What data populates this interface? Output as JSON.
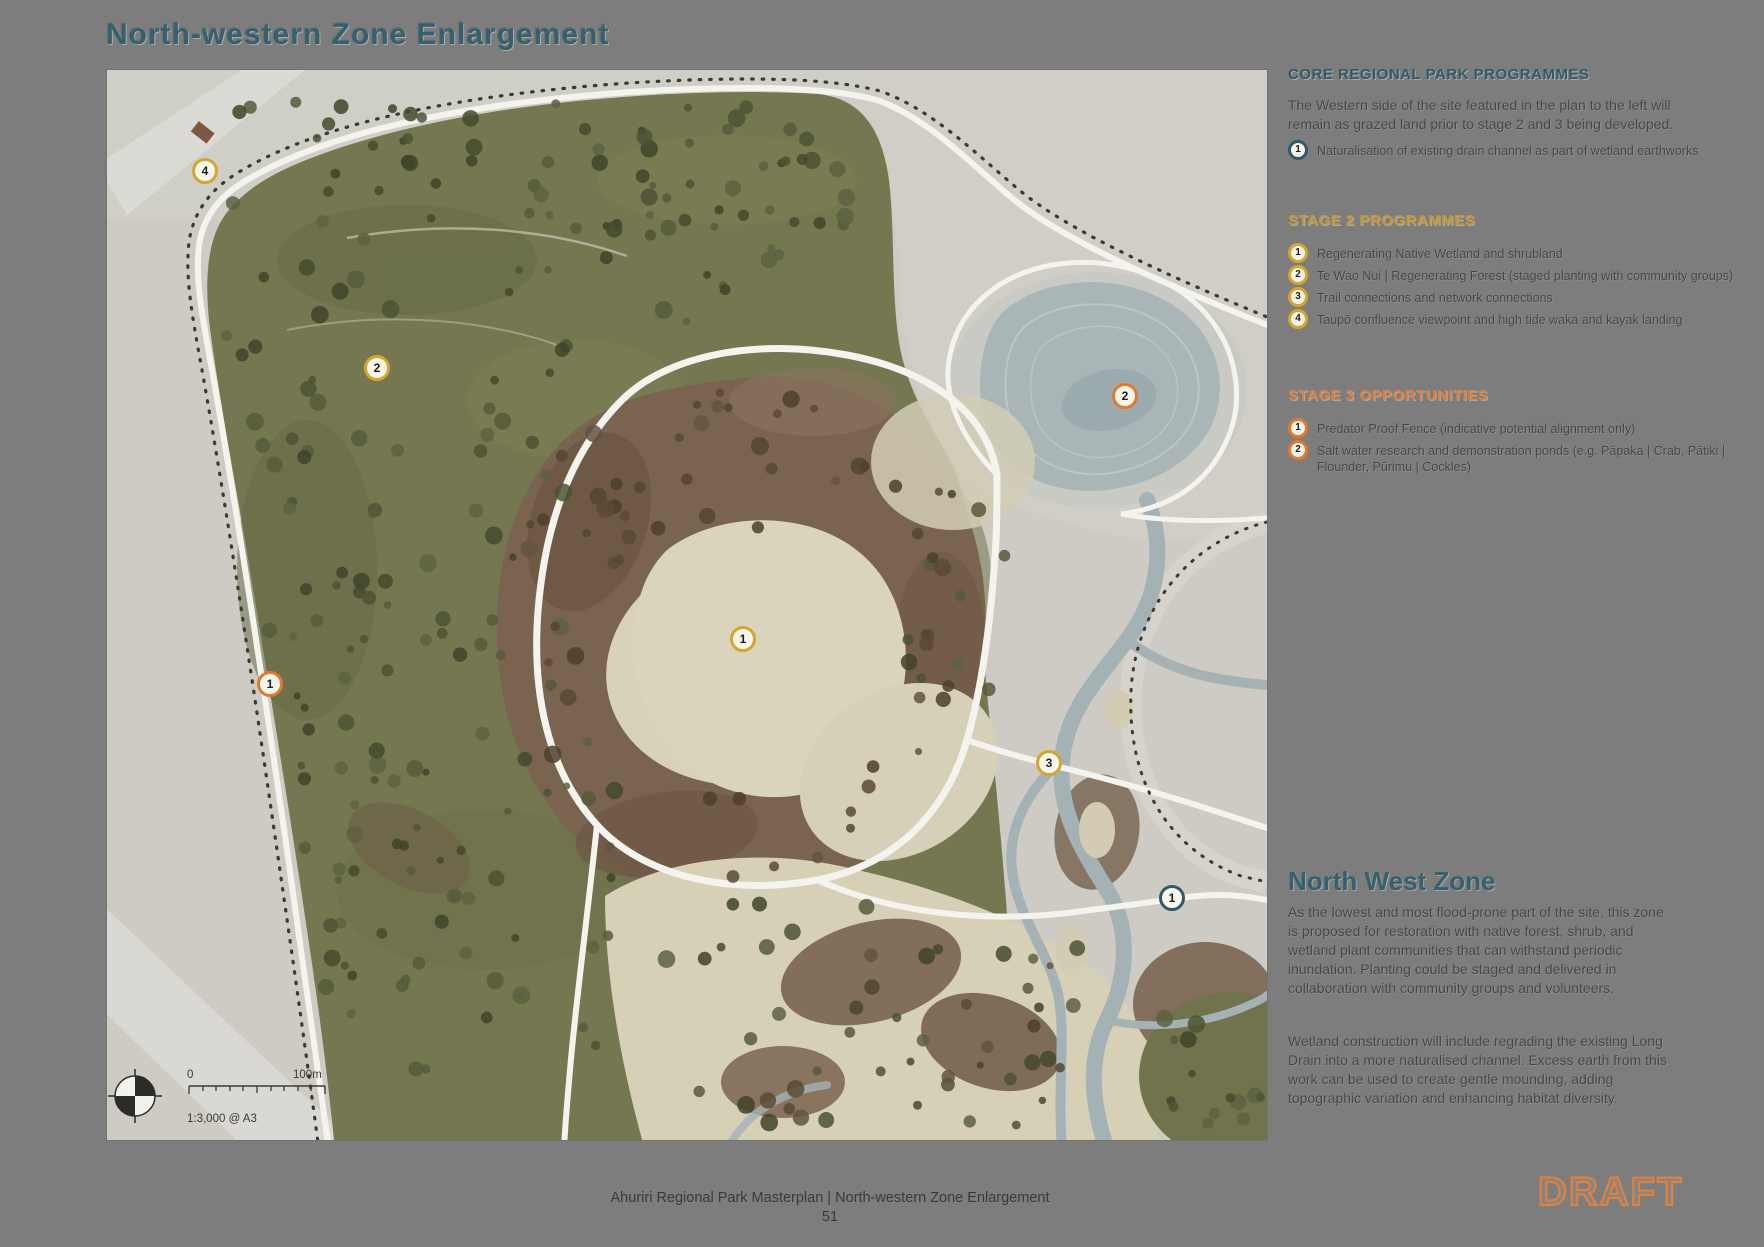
{
  "page": {
    "title": "North-western Zone Enlargement",
    "footer_line": "Ahuriri Regional Park Masterplan | North-western Zone Enlargement",
    "page_number": "51",
    "draft_label": "DRAFT"
  },
  "colors": {
    "page_bg": "#7d7d7d",
    "title_teal": "#35616f",
    "core_teal": "#2e5a68",
    "stage2_gold": "#c59733",
    "stage3_orange": "#dd7e3e",
    "draft_orange": "#e0813c",
    "body_text": "#454543"
  },
  "sidebar": {
    "core": {
      "heading": "CORE REGIONAL PARK PROGRAMMES",
      "intro": "The Western side of the site featured in the plan to the left will remain as grazed land prior to stage 2 and 3 being developed.",
      "items": [
        {
          "num": "1",
          "label": "Naturalisation of existing drain channel as part of wetland earthworks"
        }
      ]
    },
    "stage2": {
      "heading": "STAGE 2 PROGRAMMES",
      "items": [
        {
          "num": "1",
          "label": "Regenerating Native Wetland and shrubland"
        },
        {
          "num": "2",
          "label": "Te Wao Nui | Regenerating Forest (staged planting with community groups)"
        },
        {
          "num": "3",
          "label": "Trail connections and network connections"
        },
        {
          "num": "4",
          "label": "Taupō confluence viewpoint and high tide waka and kayak landing"
        }
      ]
    },
    "stage3": {
      "heading": "STAGE 3 OPPORTUNITIES",
      "items": [
        {
          "num": "1",
          "label": "Predator Proof Fence (indicative potential alignment only)"
        },
        {
          "num": "2",
          "label": "Salt water research and demonstration ponds (e.g. Pāpaka | Crab, Pātiki | Flounder, Pūrimu | Cockles)"
        }
      ]
    },
    "zone": {
      "heading": "North West Zone",
      "para1": "As the lowest and most flood-prone part of the site, this zone is proposed for restoration with native forest, shrub, and wetland plant communities that can withstand periodic inundation. Planting could be staged and delivered in collaboration with community groups and volunteers.",
      "para2": "Wetland construction will include regrading the existing Long Drain into a more naturalised channel. Excess earth from this work can be used to create gentle mounding, adding topographic variation and enhancing habitat diversity."
    }
  },
  "map": {
    "scale_zero": "0",
    "scale_end": "100m",
    "scale_ratio": "1:3,000 @ A3",
    "markers": [
      {
        "stage": "stage2",
        "num": "4",
        "x": 98,
        "y": 101
      },
      {
        "stage": "stage2",
        "num": "2",
        "x": 270,
        "y": 298
      },
      {
        "stage": "stage3",
        "num": "2",
        "x": 1018,
        "y": 326
      },
      {
        "stage": "stage2",
        "num": "1",
        "x": 636,
        "y": 569
      },
      {
        "stage": "stage3",
        "num": "1",
        "x": 163,
        "y": 614
      },
      {
        "stage": "stage2",
        "num": "3",
        "x": 942,
        "y": 693
      },
      {
        "stage": "core",
        "num": "1",
        "x": 1065,
        "y": 828
      }
    ]
  }
}
